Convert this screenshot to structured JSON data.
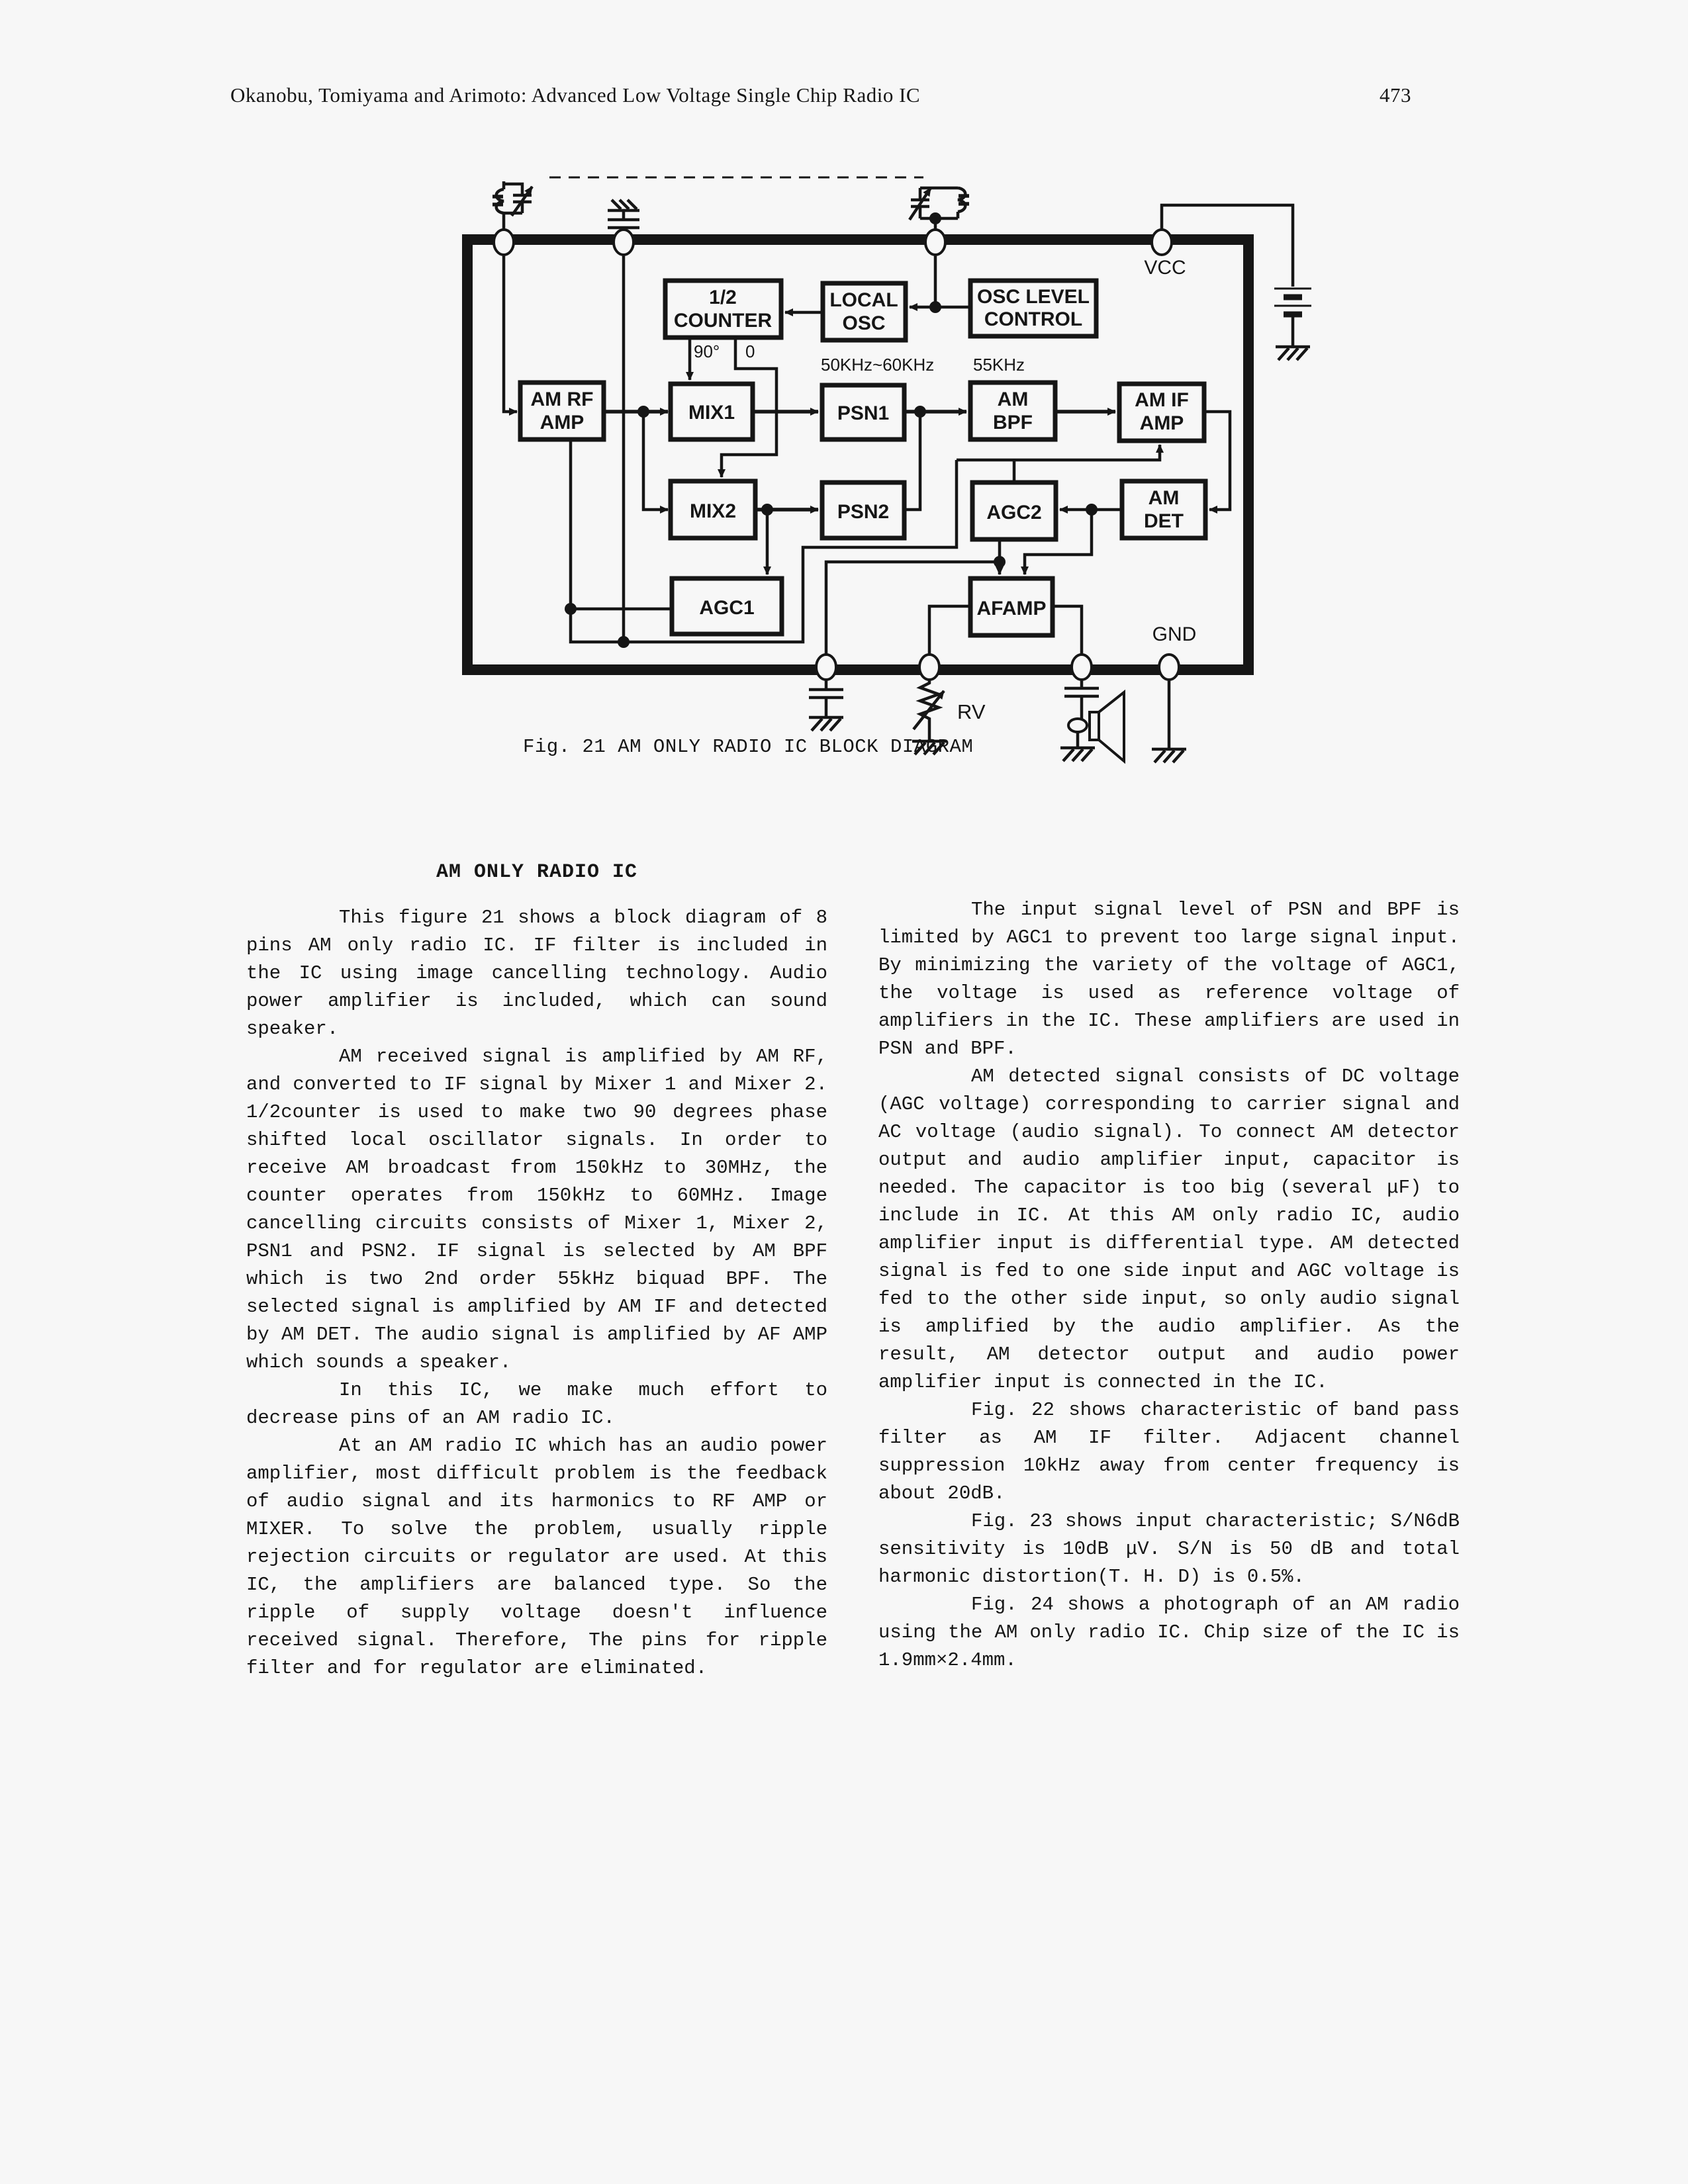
{
  "header": {
    "authors_title": "Okanobu, Tomiyama and Arimoto:   Advanced Low Voltage Single Chip Radio IC",
    "page_number": "473"
  },
  "figure": {
    "caption": "Fig. 21 AM ONLY RADIO IC BLOCK DIAGRAM",
    "power_labels": {
      "vcc": "VCC",
      "gnd": "GND"
    },
    "counter_outputs": {
      "quadrature": "90°",
      "inphase": "0"
    },
    "freq_labels": {
      "psn": "50KHz~60KHz",
      "bpf": "55KHz"
    },
    "rv_label": "RV",
    "blocks": {
      "half_counter": {
        "line1": "1/2",
        "line2": "COUNTER"
      },
      "local_osc": {
        "line1": "LOCAL",
        "line2": "OSC"
      },
      "osc_level_control": {
        "line1": "OSC LEVEL",
        "line2": "CONTROL"
      },
      "am_rf_amp": {
        "line1": "AM RF",
        "line2": "AMP"
      },
      "mix1": {
        "line1": "MIX1"
      },
      "psn1": {
        "line1": "PSN1"
      },
      "am_bpf": {
        "line1": "AM",
        "line2": "BPF"
      },
      "am_if_amp": {
        "line1": "AM IF",
        "line2": "AMP"
      },
      "mix2": {
        "line1": "MIX2"
      },
      "psn2": {
        "line1": "PSN2"
      },
      "agc2": {
        "line1": "AGC2"
      },
      "am_det": {
        "line1": "AM",
        "line2": "DET"
      },
      "agc1": {
        "line1": "AGC1"
      },
      "afamp": {
        "line1": "AFAMP"
      }
    }
  },
  "article": {
    "left_column": {
      "heading": "AM ONLY RADIO IC",
      "paragraphs": [
        "This figure 21 shows a block diagram of 8 pins AM only radio IC. IF filter is included in the IC using image cancelling technology. Audio power amplifier is included, which can sound speaker.",
        "AM received signal is amplified by AM RF, and converted to IF signal by Mixer 1 and Mixer 2. 1/2counter is used to make two 90 degrees phase shifted local oscillator signals. In order to receive AM broadcast from 150kHz to 30MHz, the counter operates from 150kHz to 60MHz. Image cancelling circuits consists of Mixer 1, Mixer 2, PSN1 and PSN2. IF signal is selected by AM BPF which is two 2nd order 55kHz biquad BPF. The selected signal is amplified by AM IF and detected by AM DET. The audio signal is amplified by AF AMP which sounds a speaker.",
        "In this IC, we make much effort to decrease pins of an AM radio IC.",
        "At an AM radio IC which has an audio power amplifier, most difficult problem is the feedback of audio signal and its harmonics to RF AMP or MIXER. To solve the problem, usually ripple rejection circuits or regulator are used. At this IC, the amplifiers are balanced type. So the ripple of supply voltage doesn't influence received signal. Therefore, The pins for ripple filter and for regulator are eliminated."
      ]
    },
    "right_column": {
      "paragraphs": [
        "The input signal level of PSN and BPF is limited by AGC1 to prevent too large signal input. By minimizing the variety of the voltage of AGC1, the voltage is used as reference voltage of amplifiers in the IC. These amplifiers are used in PSN and BPF.",
        "AM detected signal consists of DC voltage (AGC voltage) corresponding to carrier signal and AC voltage (audio signal). To connect AM detector output and audio amplifier input, capacitor is needed. The capacitor is too big (several μF) to include in IC. At this AM only radio IC, audio amplifier input is differential type. AM detected signal is fed to one side input and AGC voltage is fed to the other side input, so only audio signal is amplified by the audio amplifier. As the result, AM detector output and audio power amplifier input is connected in the IC.",
        "Fig. 22 shows characteristic of band pass filter as AM IF filter. Adjacent channel suppression 10kHz away from center frequency is about 20dB.",
        "Fig. 23 shows input characteristic; S/N6dB sensitivity is 10dB μV. S/N is 50 dB and total harmonic distortion(T. H. D) is 0.5%.",
        "Fig. 24 shows a photograph of an AM radio using the AM only radio IC. Chip size of the IC is 1.9mm×2.4mm."
      ]
    }
  }
}
